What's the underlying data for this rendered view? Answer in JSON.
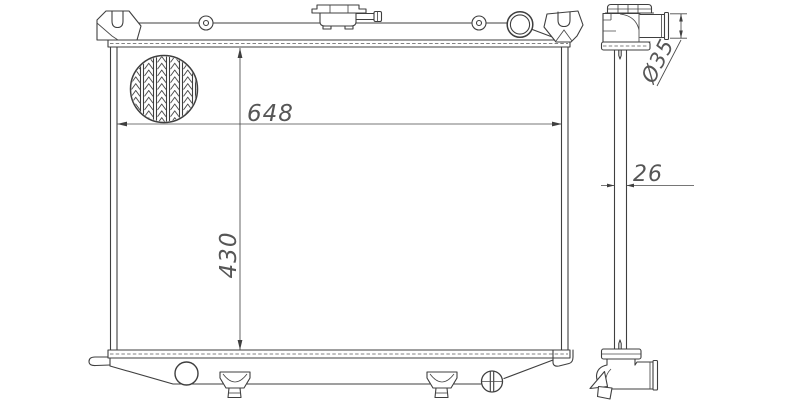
{
  "drawing": {
    "subject": "radiator-technical-drawing",
    "front_view": {
      "width_dim": "648",
      "height_dim": "430"
    },
    "side_view": {
      "depth_dim": "26",
      "pipe_diameter_dim": "Ø35"
    },
    "colors": {
      "line": "#3f3f3f",
      "dim_text": "#565656",
      "background": "#ffffff"
    }
  }
}
